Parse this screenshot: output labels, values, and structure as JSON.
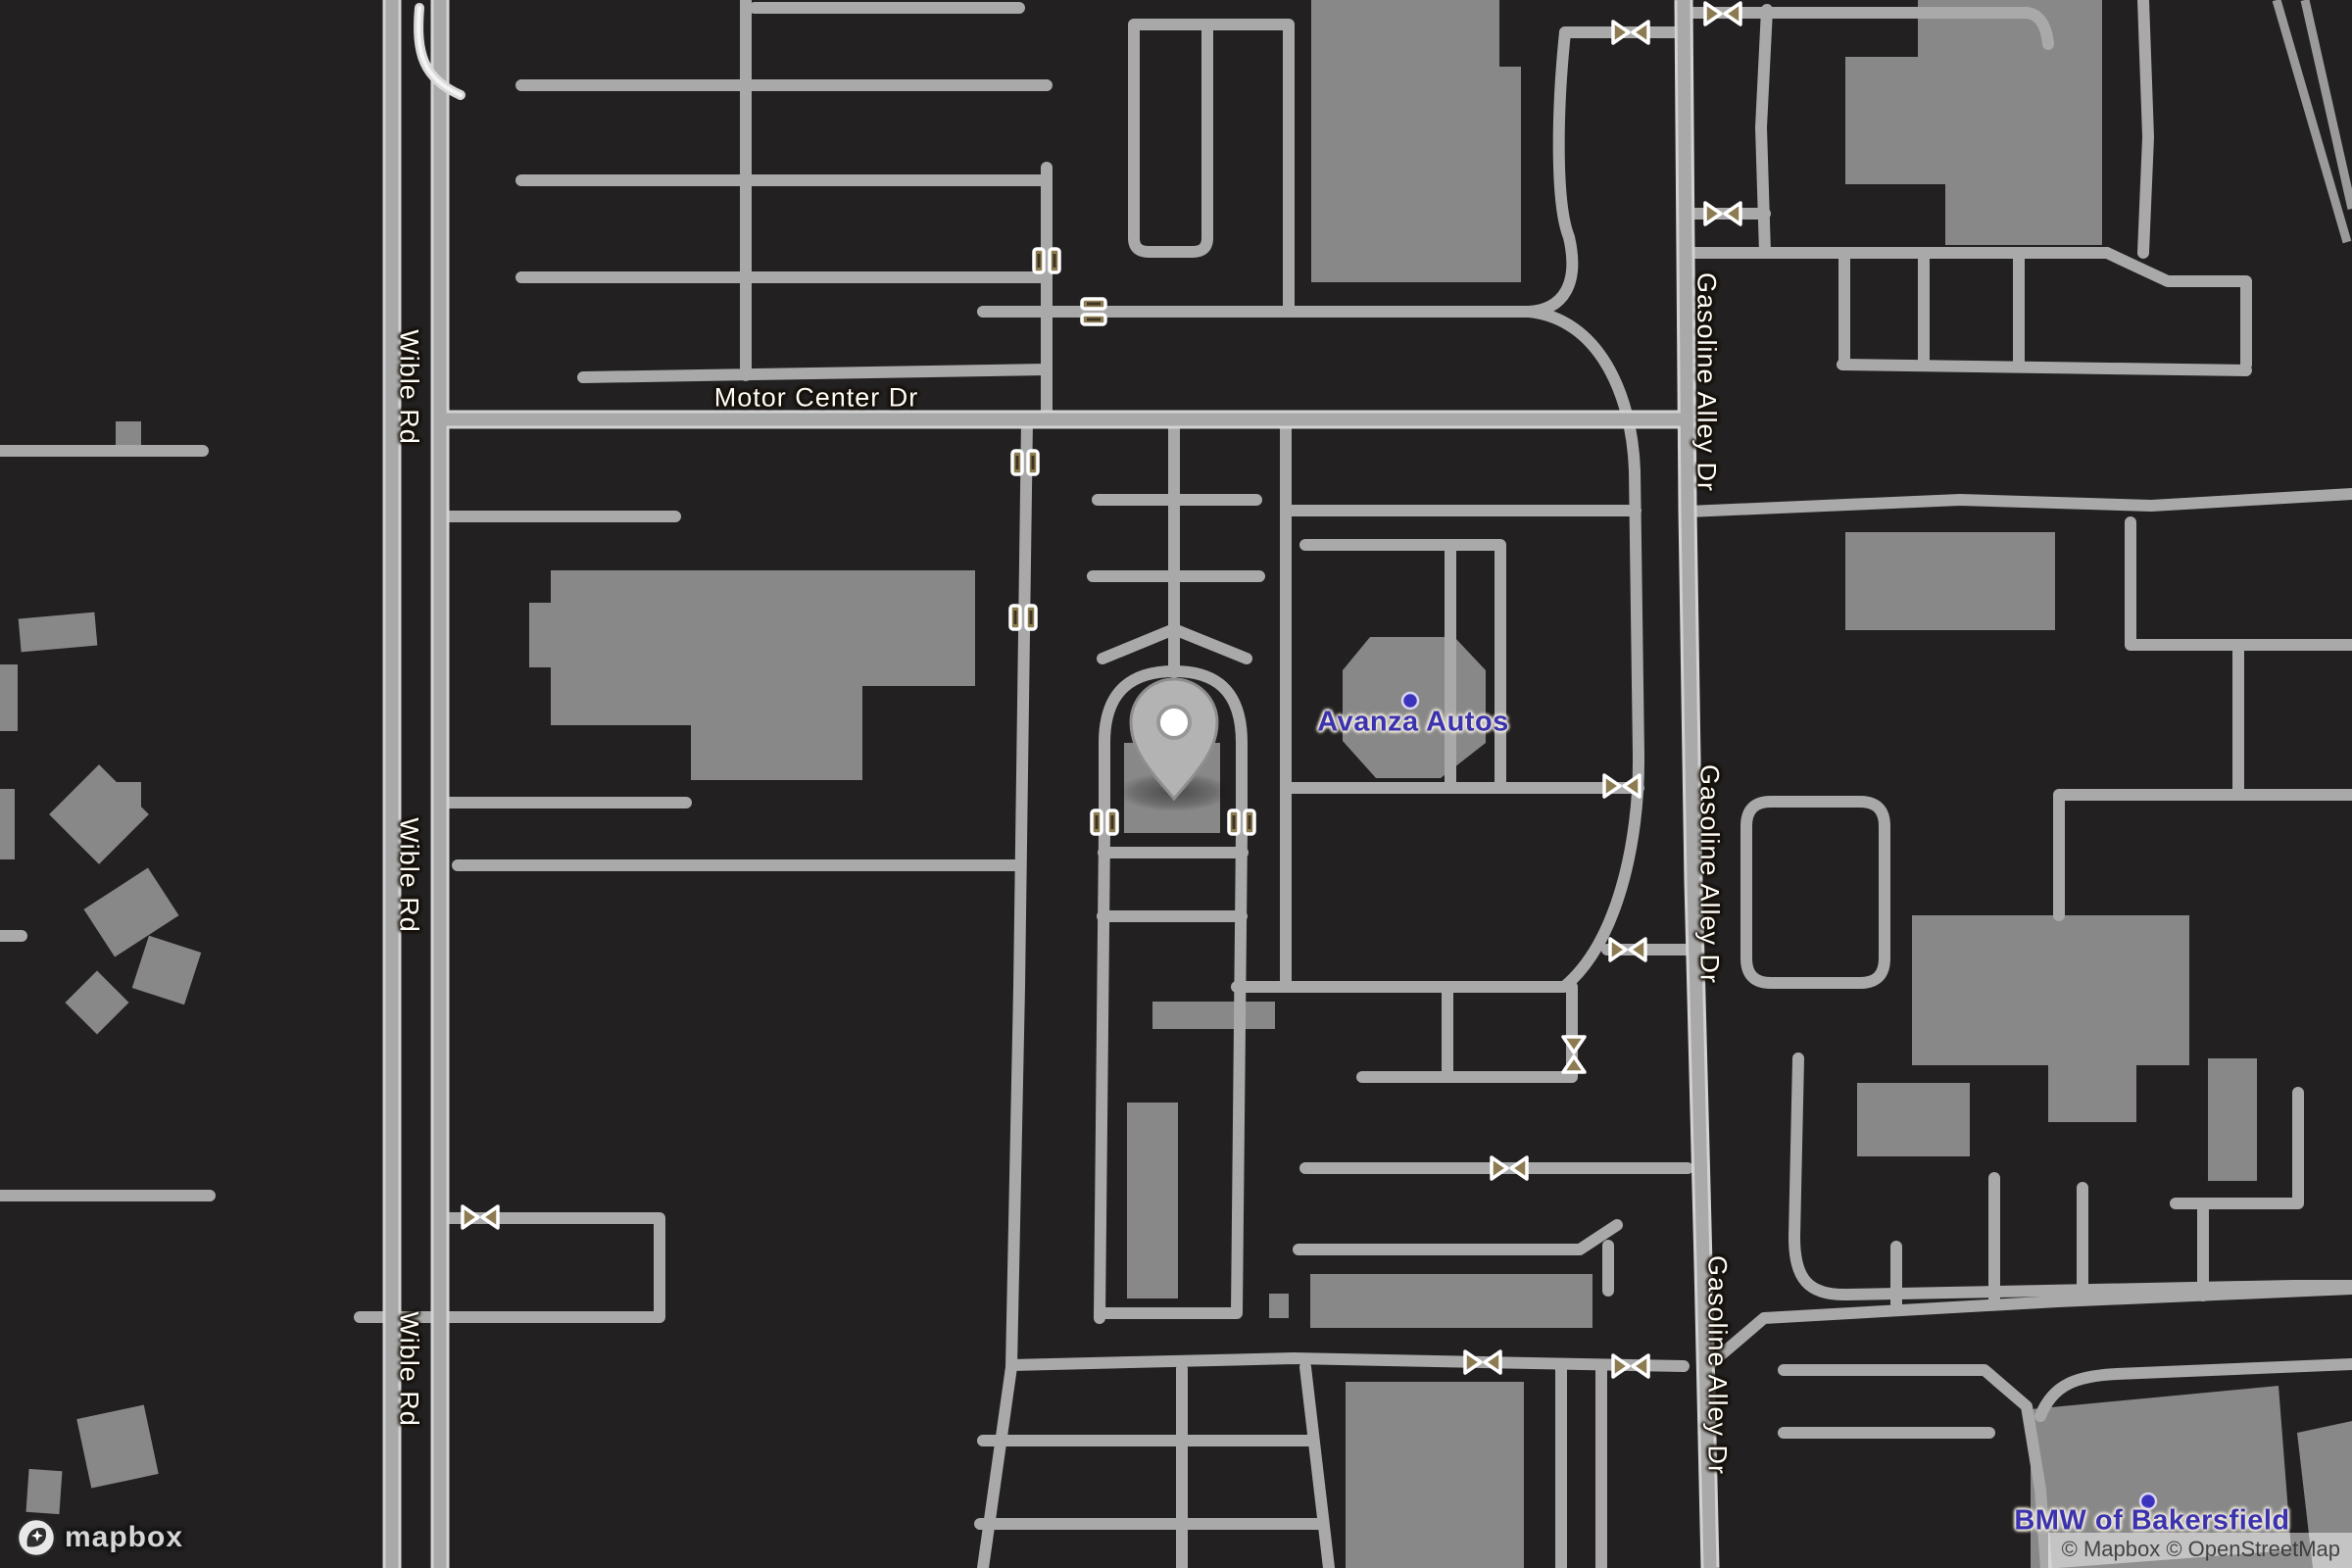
{
  "map_labels": {
    "roads": {
      "wible_rd": "Wible Rd",
      "motor_center_dr": "Motor Center Dr",
      "gasoline_alley_dr": "Gasoline Alley Dr"
    },
    "pois": {
      "avanza_autos": "Avanza Autos",
      "bmw_of_bakersfield": "BMW of Bakersfield"
    }
  },
  "branding": {
    "logo_text": "mapbox",
    "attribution_mapbox": "© Mapbox",
    "attribution_osm": "© OpenStreetMap"
  },
  "marker": {
    "type": "location-pin"
  },
  "icons": {
    "gate_count": 17
  },
  "colors": {
    "background": "#222020",
    "road_fill": "#ababab",
    "road_casing": "#d2d2d2",
    "building": "#888888",
    "road_label_text": "#fdfdfa",
    "poi_text": "#3b33ae",
    "poi_dot": "#3b33bd",
    "gate_icon": "#8d7c52",
    "marker_fill": "#b3b3b3"
  }
}
